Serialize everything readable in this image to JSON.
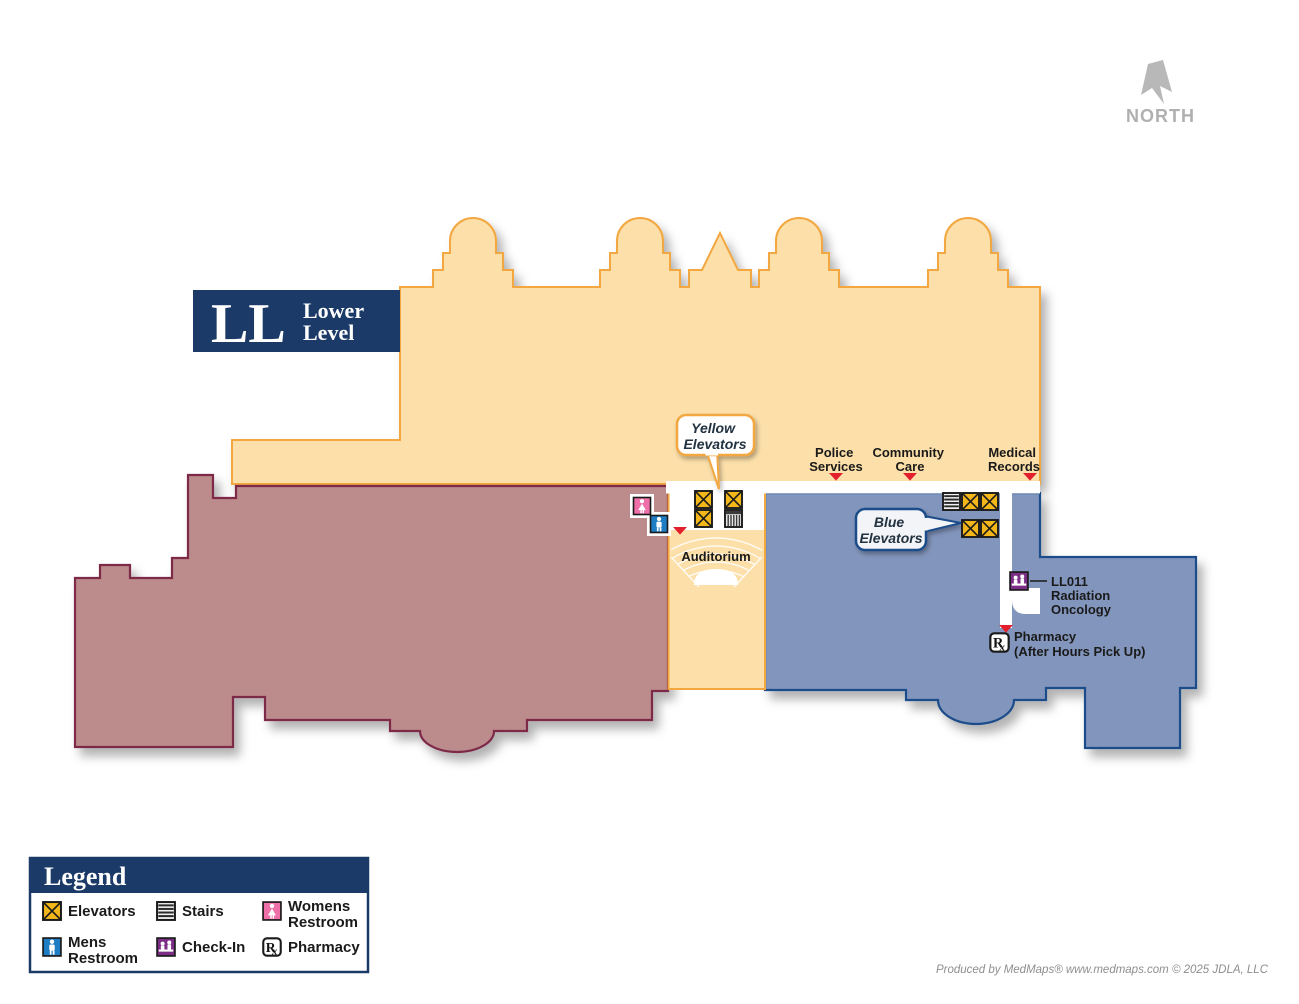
{
  "header": {
    "level_code": "LL",
    "level_name": [
      "Lower",
      "Level"
    ]
  },
  "compass": {
    "label": "NORTH"
  },
  "map": {
    "labels": {
      "police": [
        "Police",
        "Services"
      ],
      "community": [
        "Community",
        "Care"
      ],
      "medical": [
        "Medical",
        "Records"
      ],
      "auditorium": "Auditorium",
      "oncology": [
        "LL011",
        "Radiation",
        "Oncology"
      ],
      "pharmacy": [
        "Pharmacy",
        "(After Hours Pick Up)"
      ]
    },
    "callouts": {
      "yellow": [
        "Yellow",
        "Elevators"
      ],
      "blue": [
        "Blue",
        "Elevators"
      ]
    }
  },
  "icons": {
    "rx_main": "R",
    "rx_sub": "x"
  },
  "legend": {
    "title": "Legend",
    "items": [
      {
        "id": "elevators",
        "icon": "elevator-icon",
        "label": [
          "Elevators"
        ]
      },
      {
        "id": "stairs",
        "icon": "stairs-icon",
        "label": [
          "Stairs"
        ]
      },
      {
        "id": "womens-restroom",
        "icon": "womens-restroom-icon",
        "label": [
          "Womens",
          "Restroom"
        ]
      },
      {
        "id": "mens-restroom",
        "icon": "mens-restroom-icon",
        "label": [
          "Mens",
          "Restroom"
        ]
      },
      {
        "id": "check-in",
        "icon": "check-in-icon",
        "label": [
          "Check-In"
        ]
      },
      {
        "id": "pharmacy",
        "icon": "pharmacy-icon",
        "label": [
          "Pharmacy"
        ]
      }
    ]
  },
  "footer": {
    "attribution": "Produced by MedMaps®  www.medmaps.com   © 2025 JDLA, LLC"
  },
  "colors": {
    "building_fill": "#FCDFA9",
    "building_outline": "#F2A73F",
    "west_wing_fill": "#BC8B8B",
    "west_wing_outline": "#7D2A48",
    "east_wing_fill": "#8295BC",
    "east_wing_outline": "#1C4E8A",
    "navy": "#1C3A67",
    "marker_red": "#E31E2D",
    "elevator_yellow": "#F3B71A",
    "womens_pink": "#EF6FA9",
    "mens_blue": "#1F7DC4",
    "checkin_purple": "#7C2D86"
  }
}
